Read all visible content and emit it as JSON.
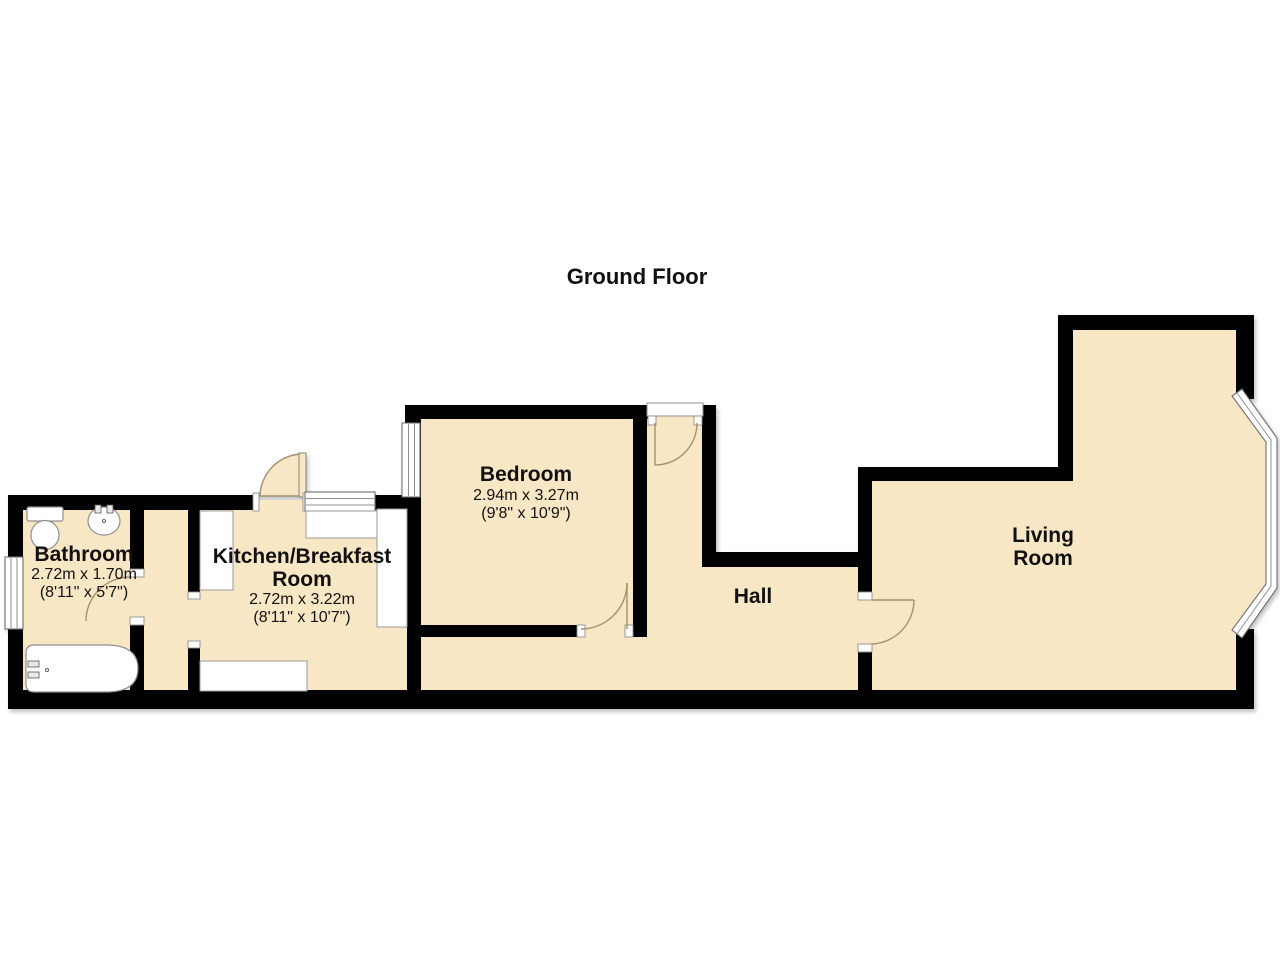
{
  "title": "Ground Floor",
  "colors": {
    "bg": "#FFFFFF",
    "floor": "#F8E7C5",
    "wall": "#000000",
    "outline": "#8F8F8F",
    "arc": "#A6906F",
    "text": "#111111"
  },
  "rooms": {
    "bathroom": {
      "name": "Bathroom",
      "metric": "2.72m x 1.70m",
      "imperial": "(8'11\" x 5'7\")"
    },
    "kitchen": {
      "name_line1": "Kitchen/Breakfast",
      "name_line2": "Room",
      "metric": "2.72m x 3.22m",
      "imperial": "(8'11\" x 10'7\")"
    },
    "bedroom": {
      "name": "Bedroom",
      "metric": "2.94m x 3.27m",
      "imperial": "(9'8\" x 10'9\")"
    },
    "hall": {
      "name": "Hall"
    },
    "living_room": {
      "name_line1": "Living",
      "name_line2": "Room"
    }
  }
}
